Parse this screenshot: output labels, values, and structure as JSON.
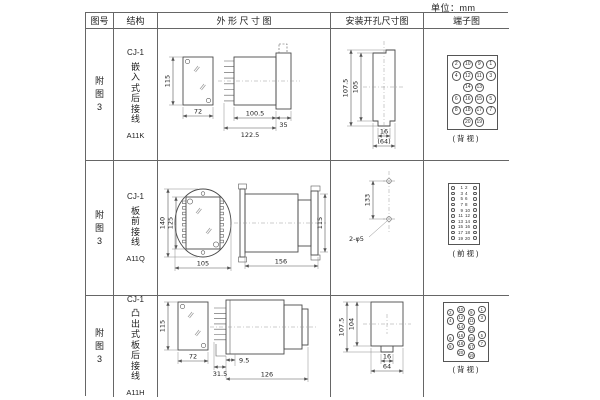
{
  "unit_label": "单位：mm",
  "table": {
    "headers": {
      "figure_no": "图号",
      "structure": "结构",
      "outline": "外 形 尺 寸 图",
      "install": "安装开孔尺寸图",
      "terminal": "端子图"
    },
    "rows": [
      {
        "figure_no_lines": [
          "附",
          "图",
          "3"
        ],
        "structure_lines": [
          "CJ-1",
          "嵌",
          "入",
          "式",
          "后",
          "接",
          "线",
          "A11K"
        ],
        "outline": {
          "height": "115",
          "width": "72",
          "body_len": "100.5",
          "total_len": "122.5",
          "flange": "35"
        },
        "install": {
          "outer_h": "107.5",
          "inner_h": "105",
          "slot_w": "16",
          "outer_w": "(64)"
        },
        "terminal": {
          "caption": "(背视)",
          "grid": [
            [
              "2",
              "10",
              "9",
              "1"
            ],
            [
              "4",
              "12",
              "11",
              "3"
            ],
            [
              "",
              "14",
              "13",
              ""
            ],
            [
              "6",
              "16",
              "15",
              "5"
            ],
            [
              "8",
              "18",
              "17",
              "7"
            ],
            [
              "",
              "20",
              "19",
              ""
            ]
          ]
        }
      },
      {
        "figure_no_lines": [
          "附",
          "图",
          "3"
        ],
        "structure_lines": [
          "CJ-1",
          "板",
          "前",
          "接",
          "线",
          "A11Q"
        ],
        "outline": {
          "outer_h": "140",
          "inner_h": "125",
          "width": "105",
          "length": "156",
          "side_h": "115"
        },
        "install": {
          "hole_span": "133",
          "hole_note": "2-φ5"
        },
        "terminal": {
          "caption": "(前视)",
          "pairs": [
            [
              "1",
              "2"
            ],
            [
              "3",
              "4"
            ],
            [
              "5",
              "6"
            ],
            [
              "7",
              "8"
            ],
            [
              "9",
              "10"
            ],
            [
              "11",
              "12"
            ],
            [
              "13",
              "14"
            ],
            [
              "15",
              "16"
            ],
            [
              "17",
              "18"
            ],
            [
              "19",
              "20"
            ]
          ]
        }
      },
      {
        "figure_no_lines": [
          "附",
          "图",
          "3"
        ],
        "structure_lines": [
          "CJ-1",
          "凸",
          "出",
          "式",
          "板",
          "后",
          "接",
          "线",
          "A11H"
        ],
        "outline": {
          "height": "115",
          "width": "72",
          "pin_len": "9.5",
          "foot": "31.5",
          "body_len": "126"
        },
        "install": {
          "outer_h": "107.5",
          "inner_h": "104",
          "slot_w": "16",
          "outer_w": "64"
        },
        "terminal": {
          "caption": "(背视)",
          "staggered": true,
          "grid": [
            [
              "2",
              "10",
              "9",
              "1"
            ],
            [
              "4",
              "12",
              "11",
              "3"
            ],
            [
              "",
              "14",
              "13",
              ""
            ],
            [
              "6",
              "16",
              "15",
              "5"
            ],
            [
              "8",
              "18",
              "17",
              "7"
            ],
            [
              "",
              "20",
              "19",
              ""
            ]
          ]
        }
      }
    ]
  }
}
